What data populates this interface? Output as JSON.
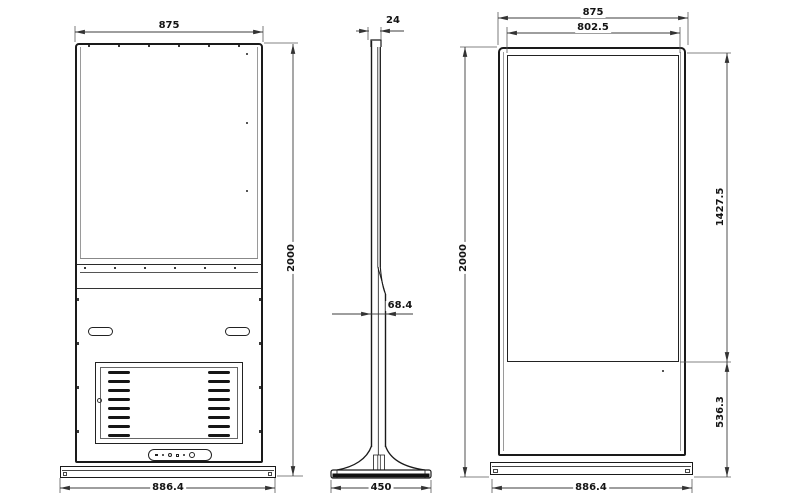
{
  "drawing": {
    "type": "engineering-dimension-drawing",
    "subject": "floor-standing kiosk / digital signage totem, three orthographic views",
    "colors": {
      "background": "#ffffff",
      "outline": "#1a1a1a",
      "dimension_lines": "#3c3c3c"
    },
    "back_view": {
      "dim_top_width": "875",
      "dim_height": "2000",
      "dim_base_width": "886.4"
    },
    "side_view": {
      "dim_panel_depth": "24",
      "dim_body_depth": "68.4",
      "dim_base_depth": "450"
    },
    "front_view": {
      "dim_top_width": "875",
      "dim_screen_width": "802.5",
      "dim_height": "2000",
      "dim_screen_height": "1427.5",
      "dim_lower_height": "536.3",
      "dim_base_width": "886.4"
    }
  }
}
